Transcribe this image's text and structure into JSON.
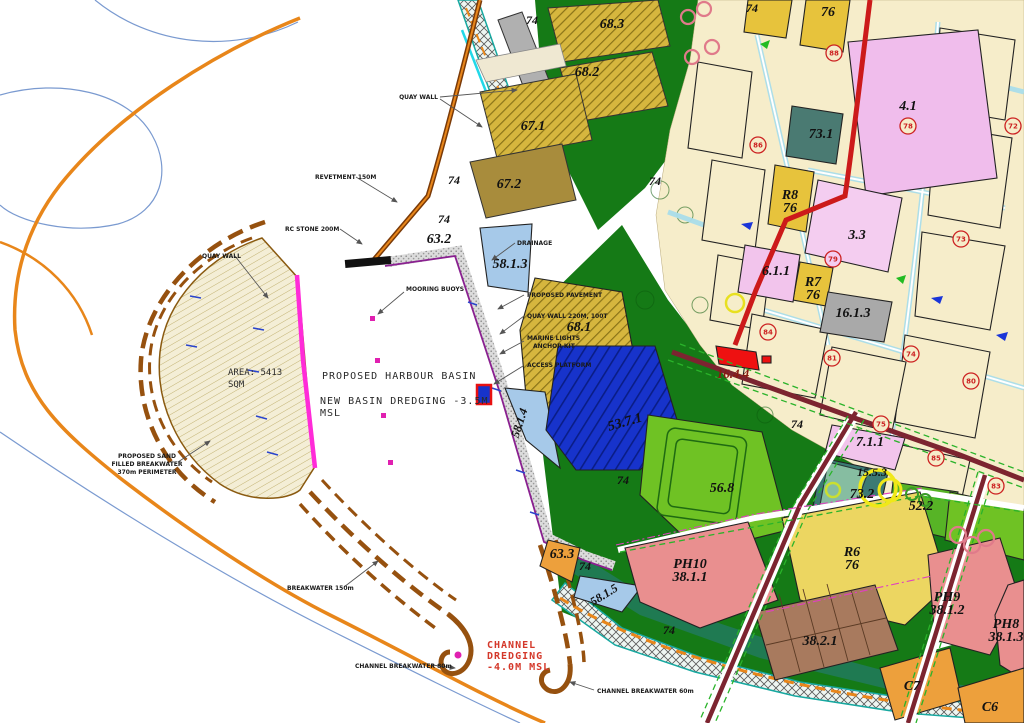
{
  "title": "Harbour development land-use site plan",
  "basin": {
    "area_line1": "AREA: 5413",
    "area_line2": "SQM",
    "title": "PROPOSED HARBOUR BASIN",
    "dredging_line1": "NEW BASIN DREDGING -3.5M",
    "dredging_line2": "MSL"
  },
  "channel_note": {
    "line1": "CHANNEL",
    "line2": "DREDGING",
    "line3": "-4.0M MSL"
  },
  "callouts": {
    "quay_wall_top": "QUAY WALL",
    "revetment": "REVETMENT 150M",
    "rc_stone": "RC STONE 200M",
    "quay_wall_left": "QUAY WALL",
    "mooring_buoys": "MOORING BUOYS",
    "drainage": "DRAINAGE",
    "proposed_pavement": "PROPOSED PAVEMENT",
    "quay_wall_220": "QUAY WALL 220M, 100T",
    "marine_lights_1": "MARINE LIGHTS",
    "marine_lights_2": "ANCHOR KIT",
    "access_platform": "ACCESS PLATFORM",
    "sand_bw_1": "PROPOSED SAND",
    "sand_bw_2": "FILLED BREAKWATER",
    "sand_bw_3": "370m PERIMETER",
    "breakwater_150": "BREAKWATER 150m",
    "channel_bw_80": "CHANNEL BREAKWATER 80m",
    "channel_bw_60": "CHANNEL BREAKWATER 60m"
  },
  "labels": {
    "p74": "74",
    "p68_3": "68.3",
    "p68_2": "68.2",
    "p67_1": "67.1",
    "p67_2": "67.2",
    "p63_2": "63.2",
    "p58_1_3": "58.1.3",
    "p68_1": "68.1",
    "p58_1_4": "58.1.4",
    "p53_7_1": "53.7.1",
    "p56_8": "56.8",
    "p4_1": "4.1",
    "p73_1": "73.1",
    "r8": "R8",
    "r8_76": "76",
    "p3_3": "3.3",
    "p6_1_1": "6.1.1",
    "r7": "R7",
    "r7_76": "76",
    "p16_1_3": "16.1.3",
    "p16_4_4": "16.4.4",
    "p7_1_1": "7.1.1",
    "p15_5_3": "15.5.3",
    "p73_2": "73.2",
    "p52_2": "52.2",
    "p63_3": "63.3",
    "p58_1_5": "58.1.5",
    "r6": "R6",
    "r6_76": "76",
    "r5_76": "76",
    "ph10": "PH10",
    "ph10_num": "38.1.1",
    "ph9": "PH9",
    "ph9_num": "38.1.2",
    "ph8": "PH8",
    "ph8_num": "38.1.3",
    "p38_2_1": "38.2.1",
    "c7": "C7",
    "c6": "C6"
  },
  "circles": {
    "c78": "78",
    "c79": "79",
    "c72": "72",
    "c73": "73",
    "c84": "84",
    "c88": "88",
    "c86": "86",
    "c81": "81",
    "c74": "74",
    "c80": "80",
    "c75": "75",
    "c85": "85",
    "c83": "83"
  },
  "colors": {
    "coast_orange": "#e8861a",
    "coast_blue": "#7a9ad0",
    "sand": "#f4eed6",
    "breakwater_brown": "#96510f",
    "quay_magenta": "#ff2bd8",
    "note_red": "#d4382a",
    "forest": "#157a16",
    "bright_green": "#6fc224",
    "cream": "#f6edca",
    "pink": "#f2c4ec",
    "yellow": "#e7c33c",
    "teal": "#3c7a74",
    "gray": "#a9a9a9",
    "blue": "#1733cb",
    "light_blue": "#a6c9e9",
    "salmon": "#e98f8f",
    "orange": "#eda03c",
    "brown_lot": "#a87a5e",
    "red_parcel": "#ee1111",
    "road_red": "#cc1a1a",
    "road_maroon": "#7c2430"
  }
}
